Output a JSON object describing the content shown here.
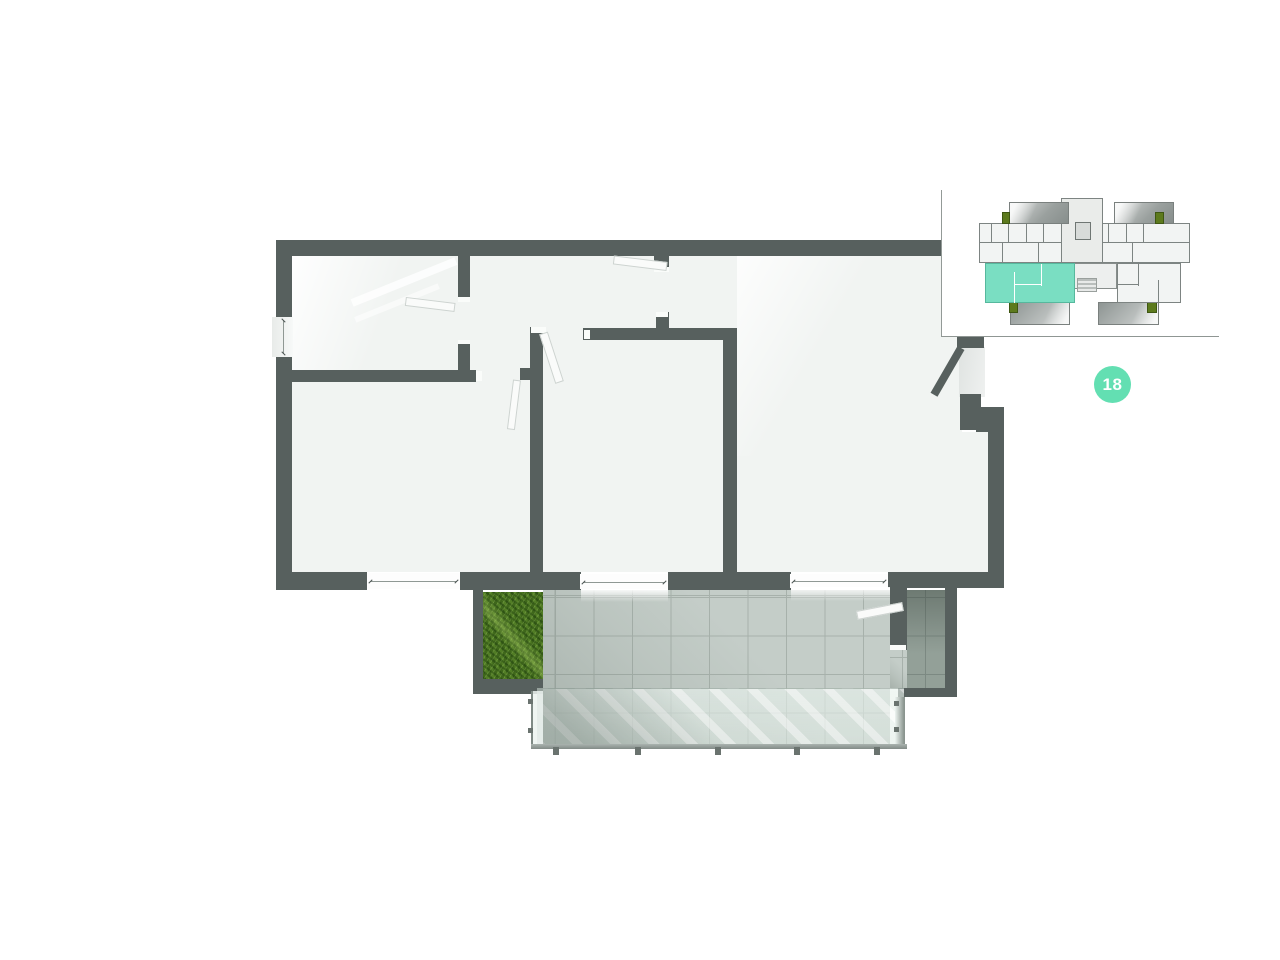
{
  "badge": {
    "label": "18"
  },
  "theme": {
    "wall": "#57605e",
    "floor": "#f1f4f2",
    "tile": "#c4cdc8",
    "tile_line": "#a7b1ab",
    "tile_dark": "#93a098",
    "tile_dark_line": "#7c8982",
    "grass": "#4c7522",
    "rail": "#99a29e",
    "post": "#6a736f",
    "accent": "#63dfb2",
    "keyplan_unit": "#7adec2",
    "keyplan_fill": "#f2f4f3",
    "keyplan_line": "#7d8482",
    "plant": "#5d7a1d",
    "door_leaf": "#fafbfa",
    "door_edge": "#cdd3d0",
    "keyplan_border": "#939a97"
  }
}
